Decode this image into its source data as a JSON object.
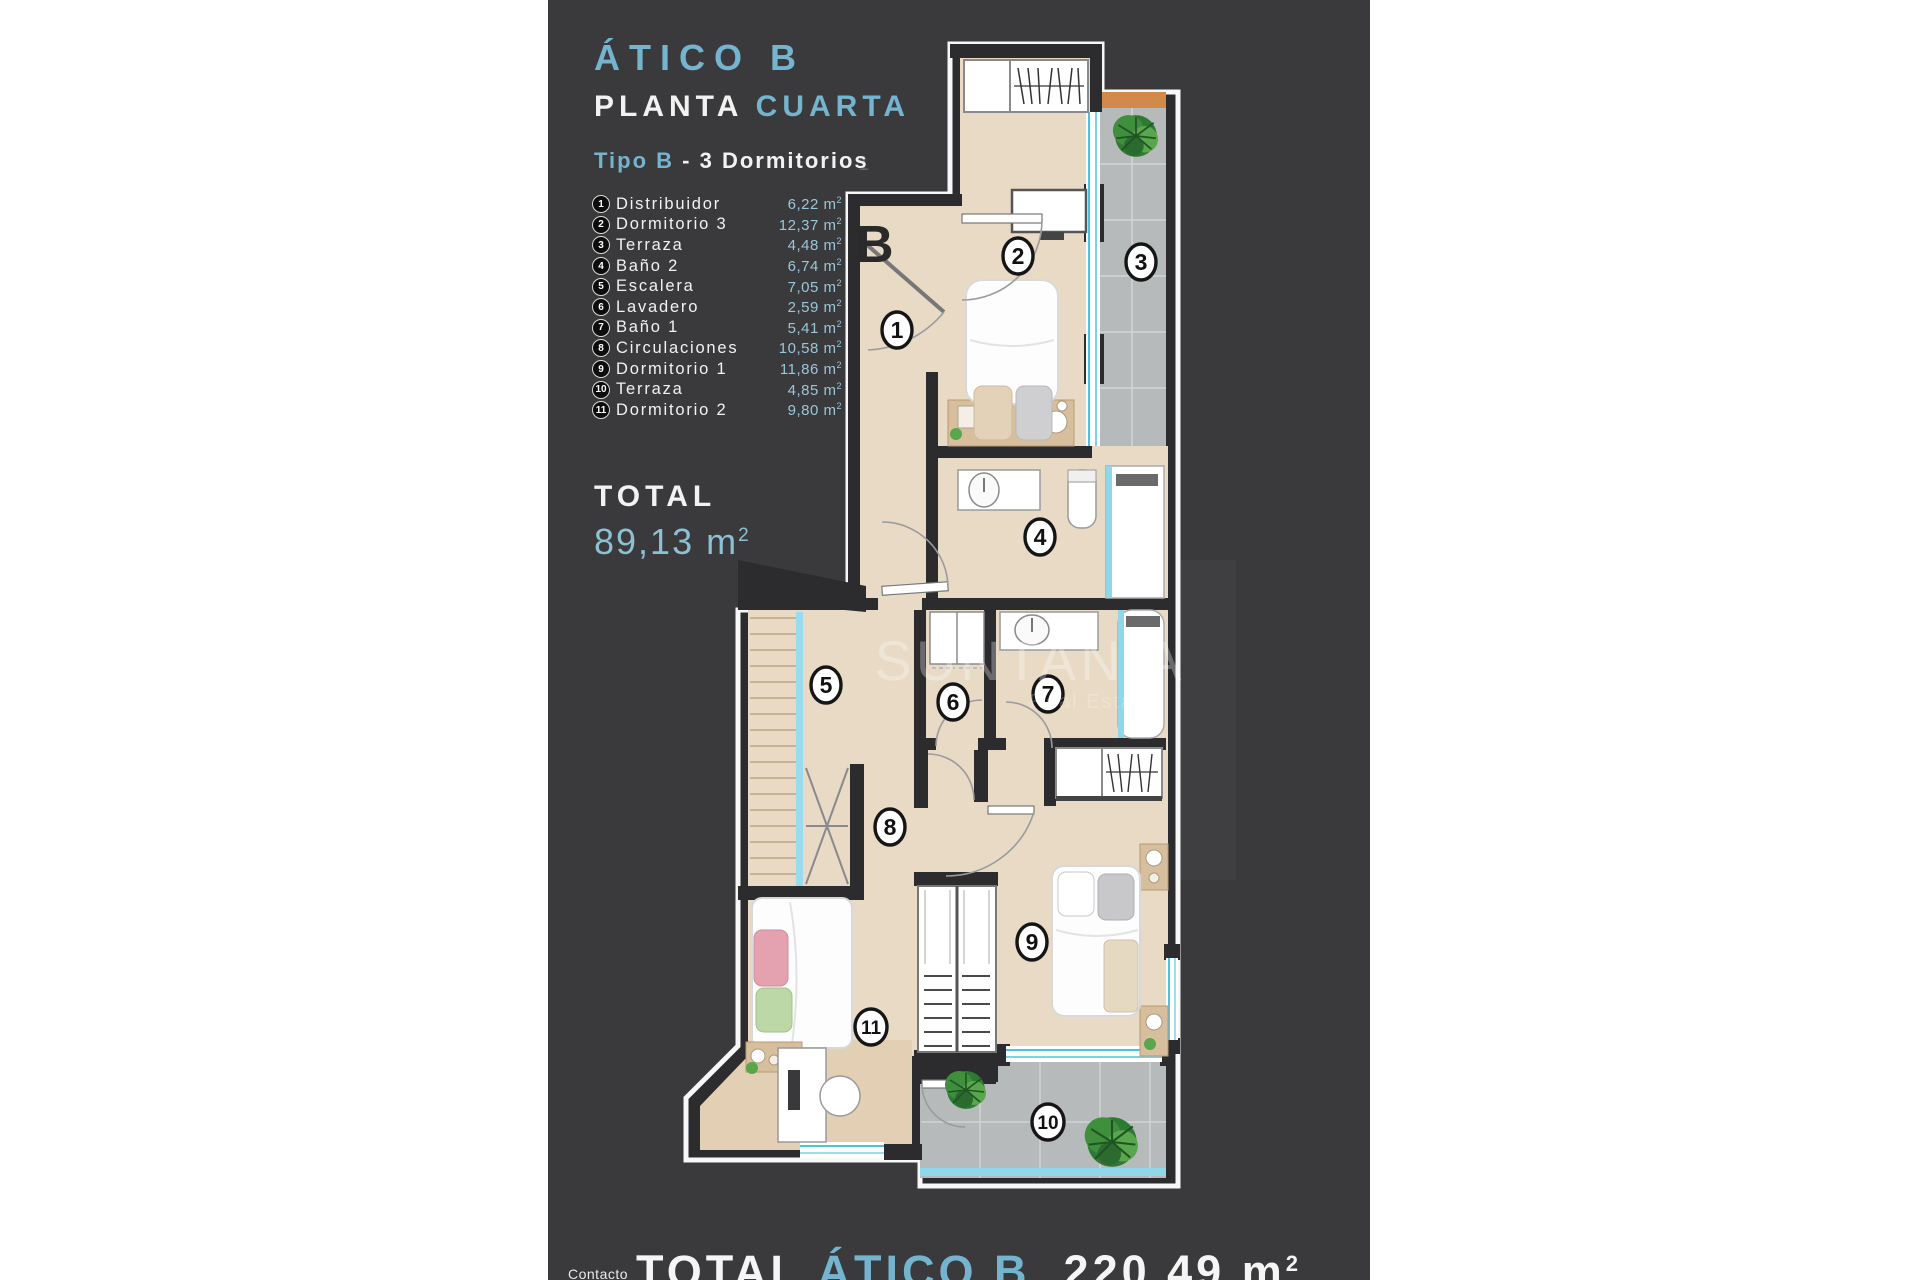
{
  "header": {
    "title": "ÁTICO B",
    "subtitle_plain": "PLANTA",
    "subtitle_accent": "CUARTA",
    "type_prefix": "Tipo B",
    "type_suffix": "- 3 Dormitorios"
  },
  "legend": {
    "items": [
      {
        "num": "1",
        "label": "Distribuidor",
        "value": "6,22"
      },
      {
        "num": "2",
        "label": "Dormitorio 3",
        "value": "12,37"
      },
      {
        "num": "3",
        "label": "Terraza",
        "value": "4,48"
      },
      {
        "num": "4",
        "label": "Baño 2",
        "value": "6,74"
      },
      {
        "num": "5",
        "label": "Escalera",
        "value": "7,05"
      },
      {
        "num": "6",
        "label": "Lavadero",
        "value": "2,59"
      },
      {
        "num": "7",
        "label": "Baño 1",
        "value": "5,41"
      },
      {
        "num": "8",
        "label": "Circulaciones",
        "value": "10,58"
      },
      {
        "num": "9",
        "label": "Dormitorio 1",
        "value": "11,86"
      },
      {
        "num": "10",
        "label": "Terraza",
        "value": "4,85"
      },
      {
        "num": "11",
        "label": "Dormitorio 2",
        "value": "9,80"
      }
    ]
  },
  "units": {
    "m": "m",
    "sup": "2"
  },
  "total": {
    "label": "TOTAL",
    "value": "89,13"
  },
  "footer": {
    "label": "TOTAL",
    "accent": "ÁTICO B",
    "value": "220,49"
  },
  "contact": "Contacto",
  "watermark": {
    "line1": "SUNTANIA",
    "line2": "Real Estate"
  },
  "plan": {
    "unit_label": "B",
    "corner_mark": "1",
    "rooms": [
      "1",
      "2",
      "3",
      "4",
      "5",
      "6",
      "7",
      "8",
      "9",
      "10",
      "11"
    ]
  },
  "colors": {
    "accent": "#74b4cf",
    "value_accent": "#9ac6da",
    "panel": "#3a3a3c",
    "wall": "#2c2c2e",
    "floor": "#e9dac5",
    "terrace": "#b7babb",
    "glass": "#7ad2e6",
    "planter": "#d28a4b"
  }
}
